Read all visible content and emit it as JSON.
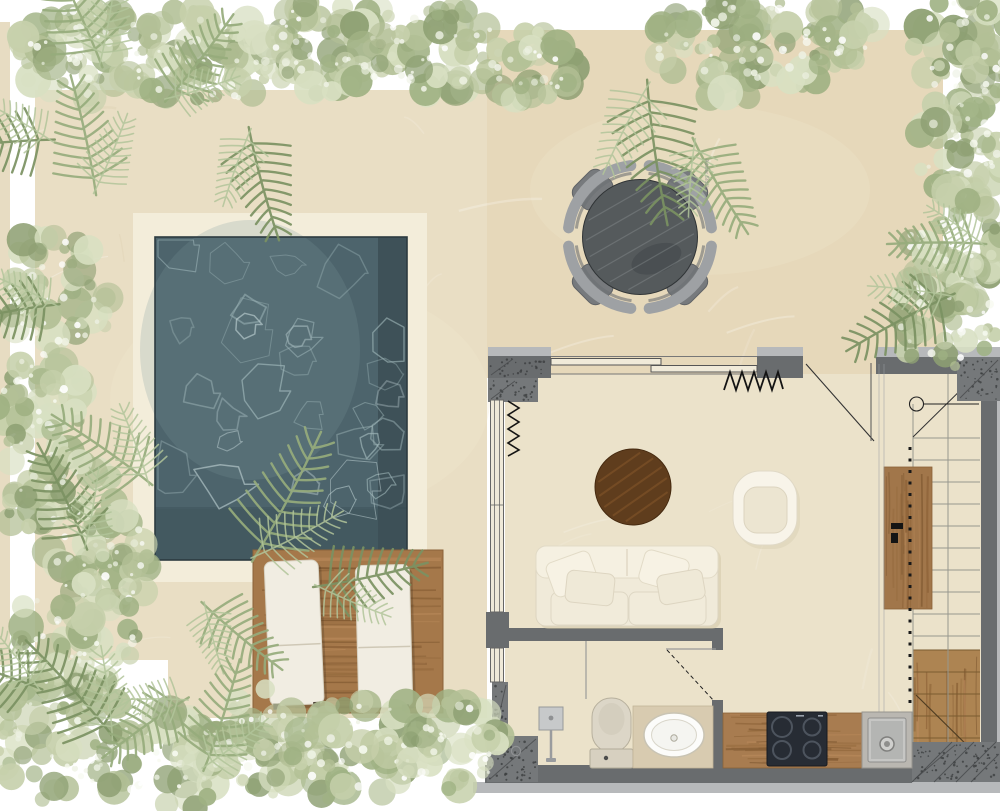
{
  "meta": {
    "title": "Top-view floor plan rendering of a studio villa with private pool",
    "kind": "architectural plan render"
  },
  "watermark": {
    "text": "Adobe Stock"
  },
  "palette": {
    "background": "#ffffff",
    "terrace_left": "#e9dec4",
    "terrace_right": "#e6d8ba",
    "interior_floor": "#ebe2ca",
    "pool_water": "#4d646c",
    "pool_surround": "#f3edda",
    "wood_deck": "#a5784a",
    "wood_cabinet": "#a1764a",
    "wall_dark": "#696c6e",
    "wall_light": "#b7b9bb",
    "concrete": "#75787a",
    "foliage_green": "#8ea073",
    "upholstery_cream": "#f2edde",
    "walnut": "#5f3d1d",
    "dining_table": "#555a5c",
    "cooktop": "#272c34"
  },
  "elements": {
    "outdoor": {
      "pool": "rectangular pool with cream stone surround",
      "sun_loungers": 2,
      "wood_deck": "timber sun deck below the pool",
      "dining_set": {
        "table": "round dark stone table",
        "chairs": 4
      },
      "planting": "sage shrubs and ferns framing the plot edges"
    },
    "indoor": {
      "living_room": [
        "cream two-seat sofa with 4 pillows",
        "round walnut coffee table",
        "cream barrel armchair"
      ],
      "bathroom": [
        "walk-in shower with drain",
        "toilet",
        "oval countertop basin on vanity"
      ],
      "kitchen": [
        "timber counter",
        "4-burner cooktop",
        "square steel sink",
        "tall timber cabinet"
      ],
      "stairs": "dog-leg staircase, timber lower flight, dashed overhead line"
    }
  }
}
